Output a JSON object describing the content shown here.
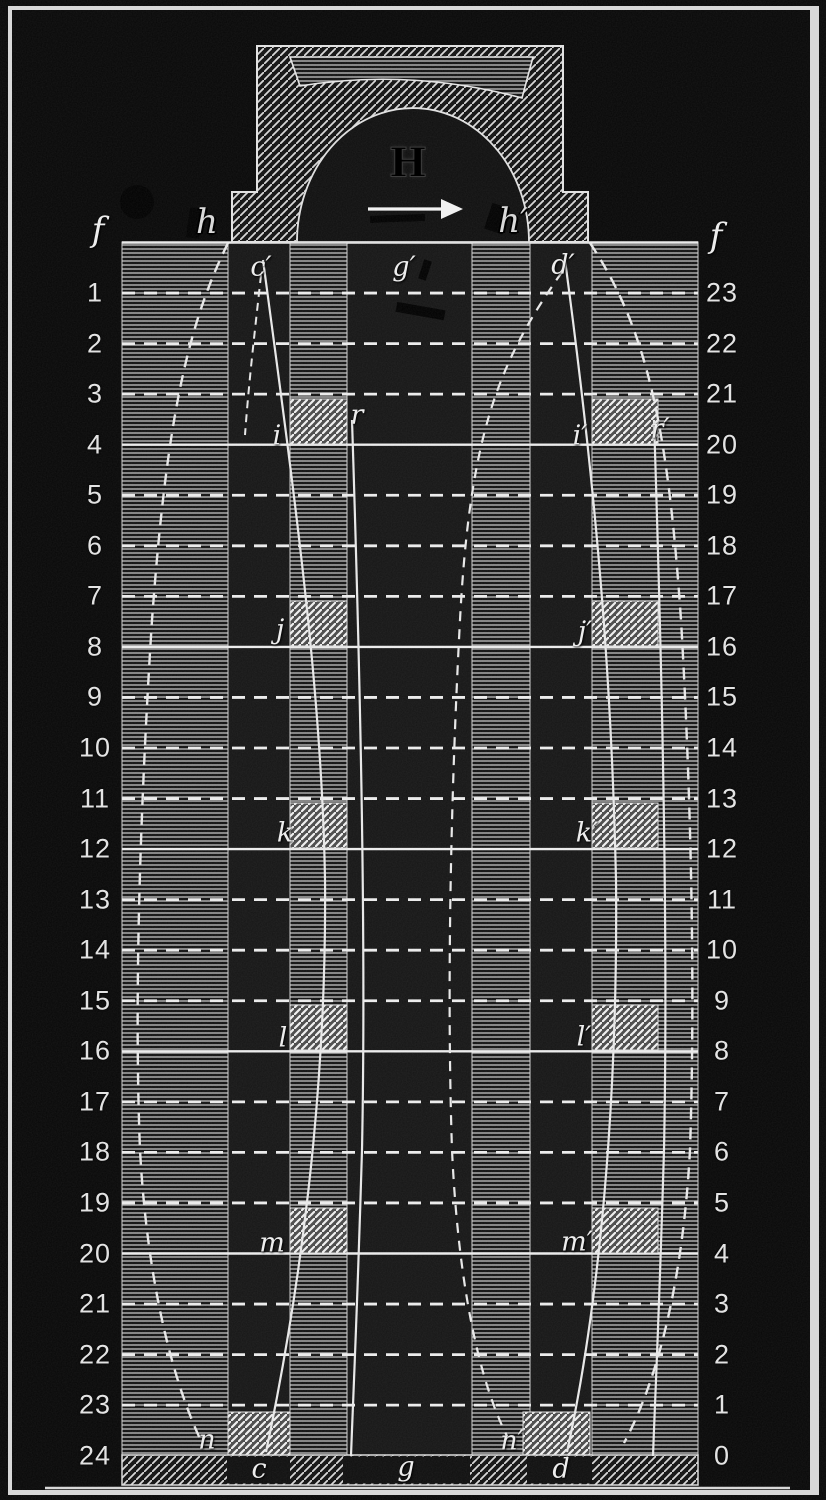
{
  "figure": {
    "colors": {
      "background": "#0a0a0a",
      "field": "#141414",
      "ink_white": "#e6e6e6",
      "hatch_line": "#c0c0c0",
      "block_bright": "#ededed",
      "frame": "#d8d8d8"
    },
    "top_structure": {
      "H": "H",
      "h": "h",
      "h_prime": "h′",
      "arrow_icon": "right-arrow"
    },
    "scale_left": {
      "header": "f",
      "values": [
        "1",
        "2",
        "3",
        "4",
        "5",
        "6",
        "7",
        "8",
        "9",
        "10",
        "11",
        "12",
        "13",
        "14",
        "15",
        "16",
        "17",
        "18",
        "19",
        "20",
        "21",
        "22",
        "23",
        "24"
      ]
    },
    "scale_right": {
      "header": "f",
      "values": [
        "23",
        "22",
        "21",
        "20",
        "19",
        "18",
        "17",
        "16",
        "15",
        "14",
        "13",
        "12",
        "11",
        "10",
        "9",
        "8",
        "7",
        "6",
        "5",
        "4",
        "3",
        "2",
        "1",
        "0"
      ]
    },
    "plot": {
      "top_points": {
        "c_prime": "c′",
        "g_prime": "g′",
        "d_prime": "d′"
      },
      "bottom_points": {
        "c": "c",
        "g": "g",
        "d": "d"
      },
      "steps_left": [
        "i",
        "j",
        "k",
        "l",
        "m",
        "n"
      ],
      "steps_right": [
        "i′",
        "j′",
        "k′",
        "l′",
        "m′",
        "n′"
      ],
      "curves": {
        "r": "r",
        "r_prime": "r′"
      }
    }
  }
}
